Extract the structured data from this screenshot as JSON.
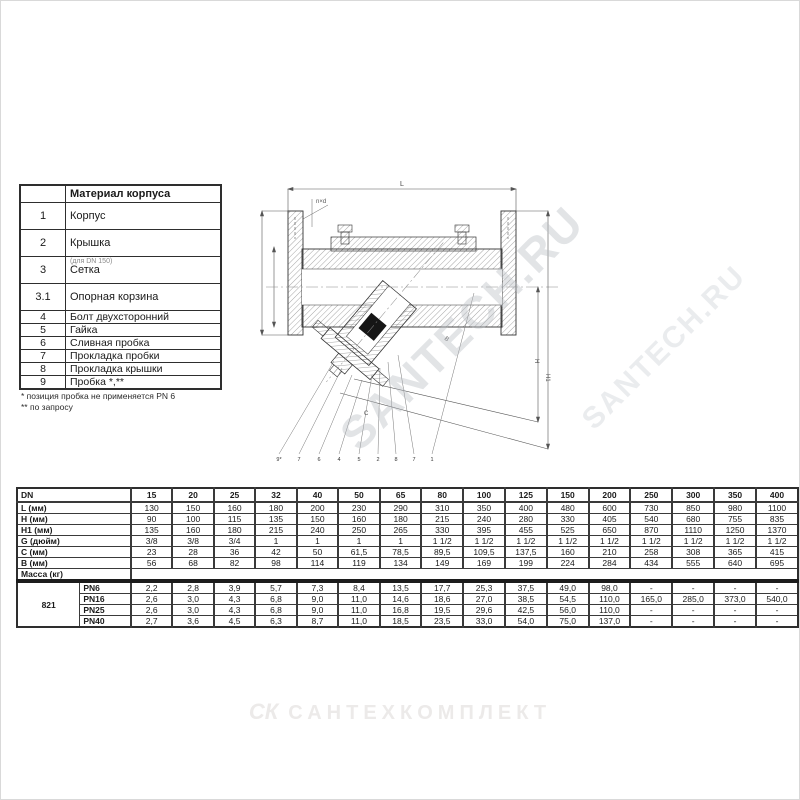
{
  "parts_table": {
    "header": "Материал корпуса",
    "rows": [
      {
        "num": "1",
        "name": "Корпус",
        "tall": true
      },
      {
        "num": "2",
        "name": "Крышка",
        "tall": true
      },
      {
        "num": "3",
        "name": "Сетка",
        "tall": true,
        "overlay": "(для DN 150)"
      },
      {
        "num": "3.1",
        "name": "Опорная корзина",
        "tall": true
      },
      {
        "num": "4",
        "name": "Болт двухсторонний"
      },
      {
        "num": "5",
        "name": "Гайка"
      },
      {
        "num": "6",
        "name": "Сливная пробка"
      },
      {
        "num": "7",
        "name": "Прокладка пробки"
      },
      {
        "num": "8",
        "name": "Прокладка крышки"
      },
      {
        "num": "9",
        "name": "Пробка *,**"
      }
    ]
  },
  "footnotes": {
    "line1": "* позиция пробка не применяется PN 6",
    "line2": "** по запросу"
  },
  "drawing": {
    "dim_labels": {
      "l": "L",
      "h": "H",
      "h1": "H1",
      "b": "B",
      "c": "C",
      "nd": "n×d"
    },
    "callouts": [
      "9*",
      "7",
      "6",
      "4",
      "5",
      "2",
      "8",
      "7",
      "1"
    ]
  },
  "watermark": {
    "diagonal_text": "SANTECH.RU",
    "logo_mark": "СК",
    "logo_text": "САНТЕХКОМПЛЕКТ"
  },
  "dims_table": {
    "corner_label": "DN",
    "dn": [
      "15",
      "20",
      "25",
      "32",
      "40",
      "50",
      "65",
      "80",
      "100",
      "125",
      "150",
      "200",
      "250",
      "300",
      "350",
      "400"
    ],
    "rows": [
      {
        "label": "L (мм)",
        "values": [
          "130",
          "150",
          "160",
          "180",
          "200",
          "230",
          "290",
          "310",
          "350",
          "400",
          "480",
          "600",
          "730",
          "850",
          "980",
          "1100"
        ]
      },
      {
        "label": "H (мм)",
        "values": [
          "90",
          "100",
          "115",
          "135",
          "150",
          "160",
          "180",
          "215",
          "240",
          "280",
          "330",
          "405",
          "540",
          "680",
          "755",
          "835"
        ]
      },
      {
        "label": "H1 (мм)",
        "values": [
          "135",
          "160",
          "180",
          "215",
          "240",
          "250",
          "265",
          "330",
          "395",
          "455",
          "525",
          "650",
          "870",
          "1110",
          "1250",
          "1370"
        ]
      },
      {
        "label": "G (дюйм)",
        "values": [
          "3/8",
          "3/8",
          "3/4",
          "1",
          "1",
          "1",
          "1",
          "1 1/2",
          "1 1/2",
          "1 1/2",
          "1 1/2",
          "1 1/2",
          "1 1/2",
          "1 1/2",
          "1 1/2",
          "1 1/2"
        ]
      },
      {
        "label": "C (мм)",
        "values": [
          "23",
          "28",
          "36",
          "42",
          "50",
          "61,5",
          "78,5",
          "89,5",
          "109,5",
          "137,5",
          "160",
          "210",
          "258",
          "308",
          "365",
          "415"
        ]
      },
      {
        "label": "B (мм)",
        "values": [
          "56",
          "68",
          "82",
          "98",
          "114",
          "119",
          "134",
          "149",
          "169",
          "199",
          "224",
          "284",
          "434",
          "555",
          "640",
          "695"
        ]
      }
    ],
    "mass_label": "Масса (кг)",
    "figure": "821",
    "mass_rows": [
      {
        "label": "PN6",
        "values": [
          "2,2",
          "2,8",
          "3,9",
          "5,7",
          "7,3",
          "8,4",
          "13,5",
          "17,7",
          "25,3",
          "37,5",
          "49,0",
          "98,0",
          "-",
          "-",
          "-",
          "-"
        ]
      },
      {
        "label": "PN16",
        "values": [
          "2,6",
          "3,0",
          "4,3",
          "6,8",
          "9,0",
          "11,0",
          "14,6",
          "18,6",
          "27,0",
          "38,5",
          "54,5",
          "110,0",
          "165,0",
          "285,0",
          "373,0",
          "540,0"
        ]
      },
      {
        "label": "PN25",
        "values": [
          "2,6",
          "3,0",
          "4,3",
          "6,8",
          "9,0",
          "11,0",
          "16,8",
          "19,5",
          "29,6",
          "42,5",
          "56,0",
          "110,0",
          "-",
          "-",
          "-",
          "-"
        ]
      },
      {
        "label": "PN40",
        "values": [
          "2,7",
          "3,6",
          "4,5",
          "6,3",
          "8,7",
          "11,0",
          "18,5",
          "23,5",
          "33,0",
          "54,0",
          "75,0",
          "137,0",
          "-",
          "-",
          "-",
          "-"
        ]
      }
    ]
  }
}
